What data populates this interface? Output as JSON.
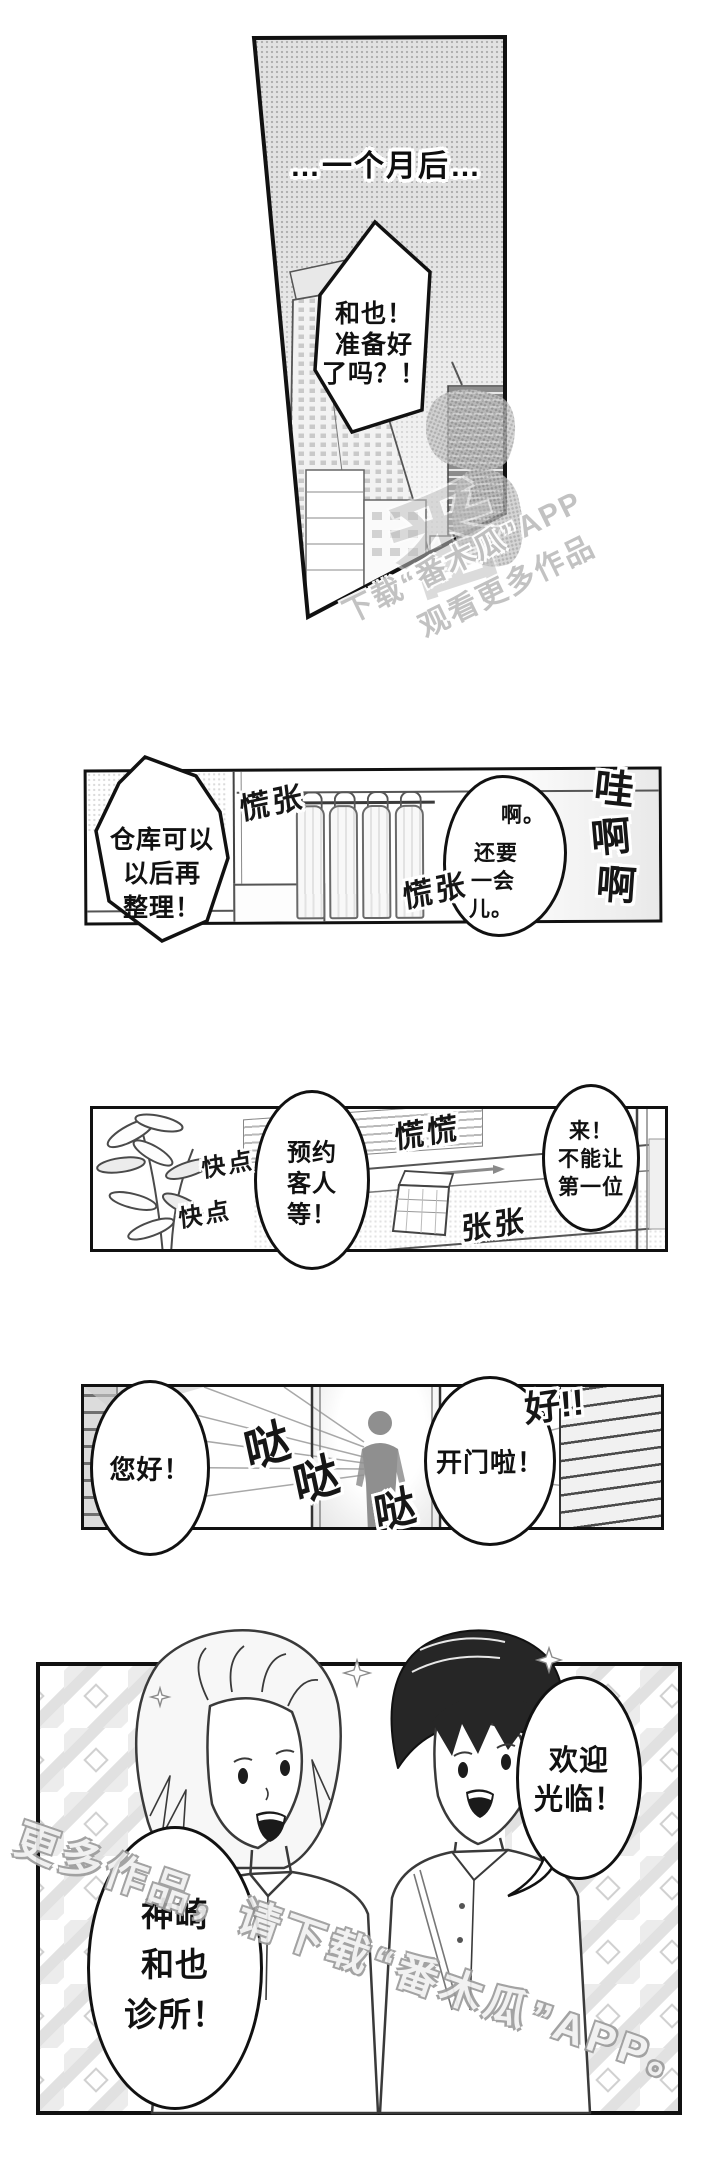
{
  "colors": {
    "ink": "#1a1a1a",
    "panel_border": "#111111",
    "tone_gray": "#e2e2e2",
    "halftone_dot": "#b0b0b0",
    "silhouette_gray": "#8f8f8f",
    "watermark_gray": "#bfbfbf",
    "hair_dark": "#262626"
  },
  "panel1": {
    "caption": "…一个月后…",
    "bubble_lines": [
      "和也！",
      "准备好",
      "了吗？！"
    ]
  },
  "watermark_top": {
    "line1": "下载“番木瓜”APP",
    "line2": "观看更多作品",
    "logo_char": "番"
  },
  "panel2": {
    "bubble_left_lines": [
      "仓库可以",
      "以后再",
      "整理！"
    ],
    "sfx_flustered_1": "慌张",
    "sfx_flustered_2": "慌张",
    "bubble_right_ah": "啊。",
    "bubble_right_lines": [
      "还要",
      "一会",
      "儿。"
    ],
    "sfx_wah_chars": [
      "哇",
      "啊",
      "啊"
    ]
  },
  "panel3": {
    "sfx_hurry_1": "快点",
    "sfx_hurry_2": "快点",
    "bubble_left_lines": [
      "预约",
      "客人",
      "等！"
    ],
    "sfx_flustered": "慌慌",
    "sfx_nervous": "张张",
    "bubble_right_lines": [
      "来！",
      "不能让",
      "第一位"
    ]
  },
  "panel4": {
    "bubble_left": "您好！",
    "sfx_knock_1": "哒",
    "sfx_knock_2": "哒",
    "sfx_knock_3": "哒",
    "bubble_right": "开门啦！",
    "sfx_good": "好!!"
  },
  "panel5": {
    "bubble_welcome_lines": [
      "欢迎",
      "光临！"
    ],
    "bubble_clinic_lines": [
      "神崎",
      "和也",
      "诊所！"
    ]
  },
  "watermark_bottom": "更多作品，请下载“番木瓜”APP。"
}
